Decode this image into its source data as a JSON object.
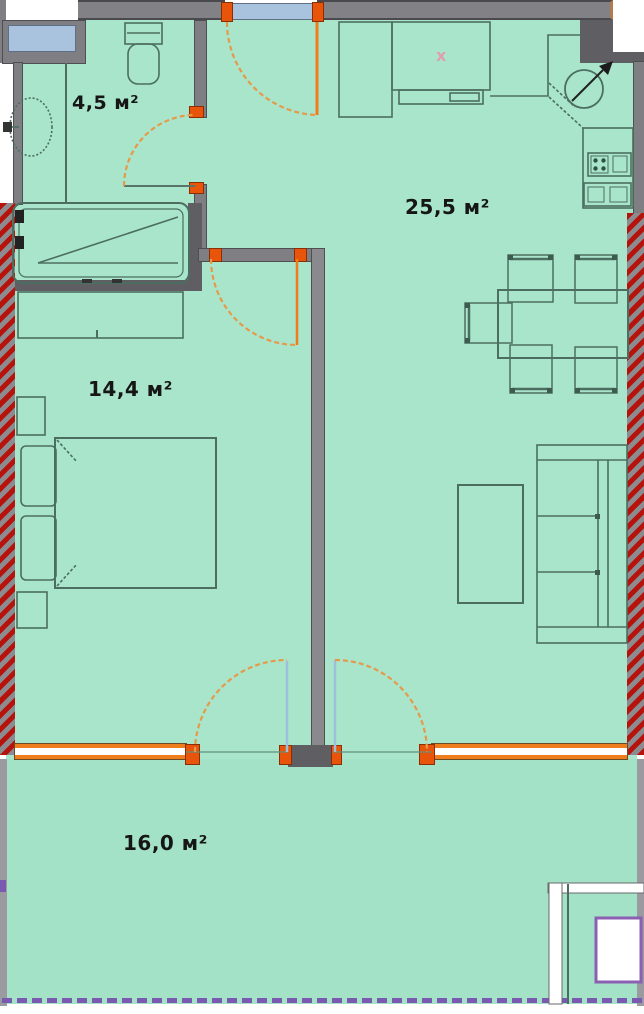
{
  "plan_type": "apartment floor plan",
  "rooms": [
    {
      "id": "bathroom",
      "area_label": "4,5 м²",
      "furniture": [
        "toilet",
        "washbasin",
        "bathtub"
      ]
    },
    {
      "id": "kitchen-living-room",
      "area_label": "25,5 м²",
      "furniture": [
        "kitchen cabinets",
        "round sink",
        "stove",
        "dining table",
        "chairs",
        "sofa",
        "coffee table"
      ]
    },
    {
      "id": "bedroom",
      "area_label": "14,4 м²",
      "furniture": [
        "wardrobe",
        "double bed",
        "nightstands"
      ]
    },
    {
      "id": "balcony",
      "area_label": "16,0 м²",
      "furniture": []
    }
  ],
  "marks": {
    "kitchen_sink_x": "x"
  },
  "colors": {
    "floor": "#a8e5cb",
    "balcony_floor": "#a3e2c6",
    "wall_gray": "#7f7f83",
    "wall_dark": "#5f5f63",
    "exterior_hatch_red": "#b5130c",
    "exterior_hatch_gray": "#8c8c90",
    "door_orange": "#ee7d1c",
    "hinge_orange": "#e8540a",
    "window_blue": "#a9c2dd",
    "furniture_stroke": "#4c6e60",
    "balcony_dash_purple": "#7a5ab0",
    "label_text": "#161616"
  }
}
